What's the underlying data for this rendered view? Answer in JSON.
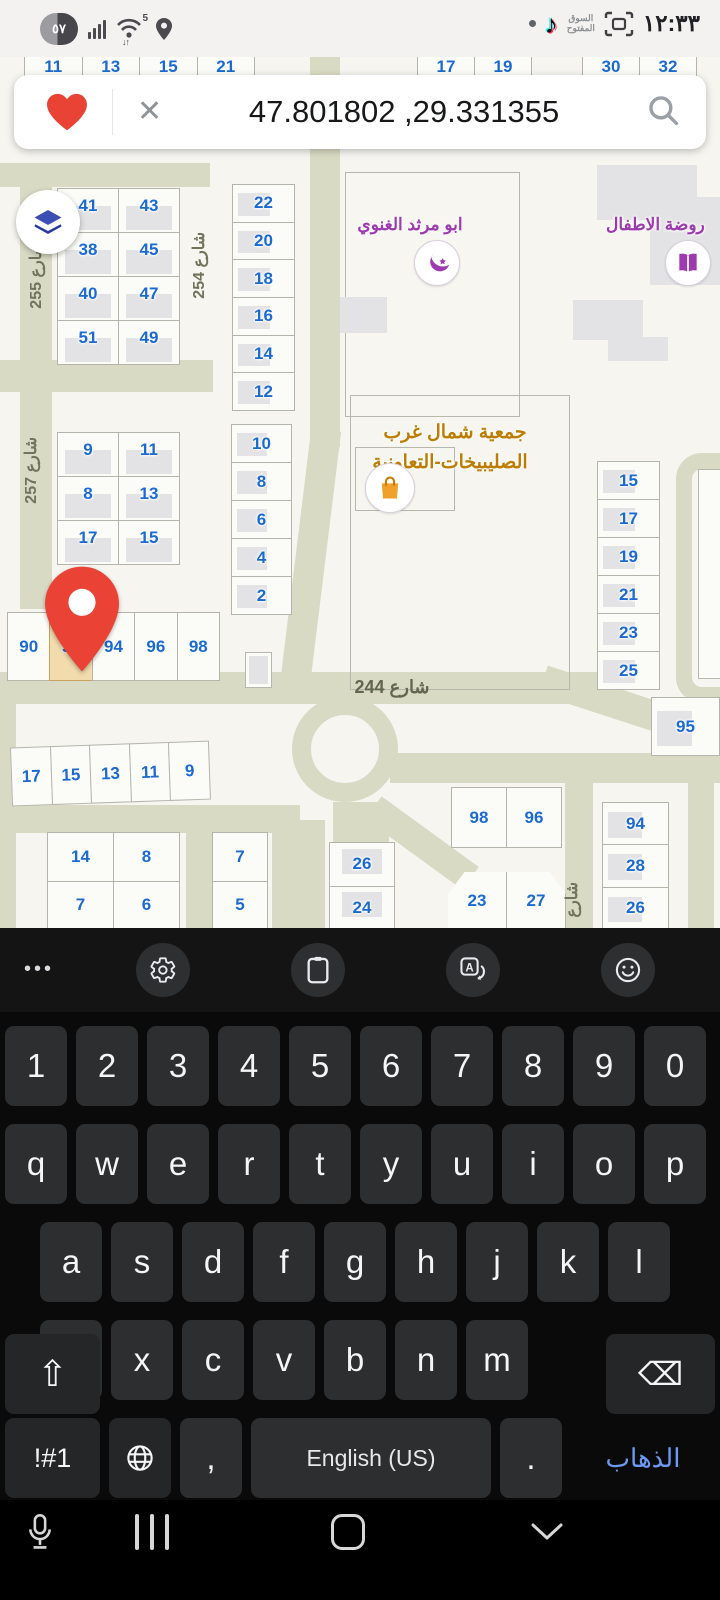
{
  "status_bar": {
    "battery_percent": "٥٧",
    "wifi_badge": "5",
    "wifi_arrows": "↓↑",
    "tiktok_glyph": "♪",
    "opensooq_line1": "السوق",
    "opensooq_line2": "المفتوح",
    "time": "١٢:٣٣"
  },
  "search_bar": {
    "query": "47.801802 ,29.331355"
  },
  "map": {
    "streets": {
      "s255": "شارع 255",
      "s254": "شارع 254",
      "s257": "شارع 257",
      "s244": "شارع 244",
      "s_partial": "شارع"
    },
    "pois": {
      "mosque": "ابو مرثد الغنوي",
      "kindergarten": "روضة الاطفال",
      "coop_line1": "جمعية شمال غرب",
      "coop_line2": "الصليبيخات-التعاونية"
    },
    "blocks": {
      "top_left": [
        "11",
        "13",
        "15",
        "21"
      ],
      "top_right_a": [
        "17",
        "19"
      ],
      "top_right_b": [
        "30",
        "32"
      ],
      "b41": [
        "41",
        "43",
        "38",
        "45",
        "40",
        "47",
        "51",
        "49"
      ],
      "col22": [
        "22",
        "20",
        "18",
        "16",
        "14",
        "12"
      ],
      "b9": [
        "9",
        "11",
        "8",
        "13",
        "17",
        "15"
      ],
      "col10": [
        "10",
        "8",
        "6",
        "4",
        "2"
      ],
      "row90": [
        "90",
        "92",
        "94",
        "96",
        "98"
      ],
      "col15r": [
        "15",
        "17",
        "19",
        "21",
        "23",
        "25"
      ],
      "p95": "95",
      "row17": [
        "17",
        "15",
        "13",
        "11",
        "9"
      ],
      "b14": [
        "14",
        "8",
        "7",
        "6"
      ],
      "col7": [
        "7",
        "5"
      ],
      "col26": [
        "26",
        "24"
      ],
      "row98": [
        "98",
        "96"
      ],
      "row23": [
        "23",
        "27"
      ],
      "col94": [
        "94",
        "28",
        "26"
      ]
    },
    "selected_plot": "92",
    "colors": {
      "road": "#d8dac3",
      "plot_number": "#1a6ad1",
      "street_label": "#70745c",
      "poi_purple": "#9d3ab0",
      "poi_orange": "#bc7d00",
      "selected_fill": "#f2dcae",
      "pin_red": "#ea4335"
    }
  },
  "keyboard": {
    "rows": {
      "numbers": [
        "1",
        "2",
        "3",
        "4",
        "5",
        "6",
        "7",
        "8",
        "9",
        "0"
      ],
      "r1": [
        "q",
        "w",
        "e",
        "r",
        "t",
        "y",
        "u",
        "i",
        "o",
        "p"
      ],
      "r2": [
        "a",
        "s",
        "d",
        "f",
        "g",
        "h",
        "j",
        "k",
        "l"
      ],
      "r3": [
        "z",
        "x",
        "c",
        "v",
        "b",
        "n",
        "m"
      ]
    },
    "symbols_key": "!#1",
    "comma_key": ",",
    "space_label": "English (US)",
    "period_key": ".",
    "go_key": "الذهاب",
    "backspace_glyph": "⌫",
    "shift_glyph": "⇧"
  }
}
